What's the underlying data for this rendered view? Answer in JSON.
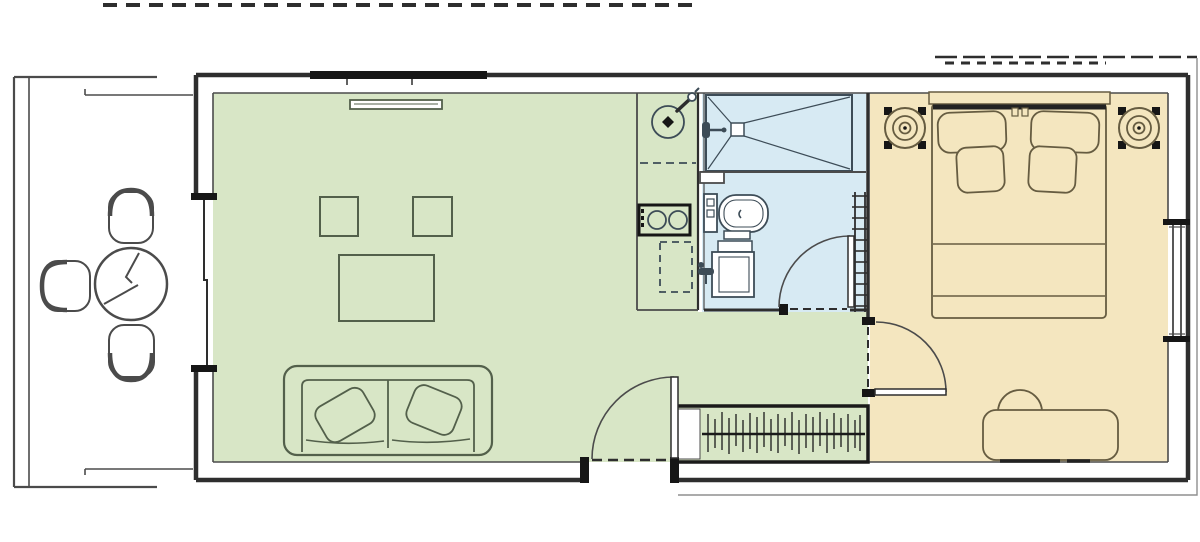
{
  "page": {
    "background": "#ffffff"
  },
  "colors": {
    "paper": "#ffffff",
    "living_room_fill": "#d8e6c6",
    "bathroom_fill": "#d7eaf3",
    "bedroom_fill": "#f4e6bf",
    "wall_dark": "#2e2e2e",
    "line_medium": "#4b4b4b",
    "living_furniture_stroke": "#53604b",
    "bedroom_furniture_stroke": "#665c41",
    "bathroom_fixture_stroke": "#3d4c57",
    "black_detail": "#161616",
    "eave_gray": "#8f8f8f"
  },
  "floor_plan": {
    "rooms": [
      {
        "name": "deck",
        "fill": "#ffffff",
        "furniture": [
          "bistro-table",
          "chair-top",
          "chair-left",
          "chair-bottom"
        ]
      },
      {
        "name": "living-room",
        "fill": "#d8e6c6",
        "furniture": [
          "wall-tv",
          "side-table-left",
          "side-table-right",
          "coffee-table",
          "sofa-with-pillows"
        ]
      },
      {
        "name": "kitchen",
        "fill": "#d8e6c6",
        "furniture": [
          "round-sink",
          "sink-faucet",
          "two-burner-hob",
          "under-counter-appliance-dashed"
        ]
      },
      {
        "name": "bathroom",
        "fill": "#d7eaf3",
        "furniture": [
          "shower-tray",
          "shower-head",
          "toilet",
          "washbasin",
          "towel-radiator"
        ]
      },
      {
        "name": "bedroom",
        "fill": "#f4e6bf",
        "furniture": [
          "double-bed",
          "headboard",
          "pillow-left",
          "pillow-right",
          "cushion-left",
          "cushion-right",
          "speaker-left",
          "speaker-right",
          "bench-seat"
        ]
      },
      {
        "name": "wardrobe",
        "fill": "#d8e6c6",
        "furniture": [
          "hanging-rail",
          "clothes-hangers"
        ]
      }
    ],
    "openings": [
      "roof-overhang-dashed-top-left",
      "roof-line-top-right",
      "eave-outline-bottom-right",
      "sliding-door-left-wall",
      "entry-door-bottom-wall",
      "bathroom-door",
      "bedroom-door",
      "window-right-wall",
      "rooflight-dashed-top-wall",
      "high-window-top-wall"
    ]
  }
}
